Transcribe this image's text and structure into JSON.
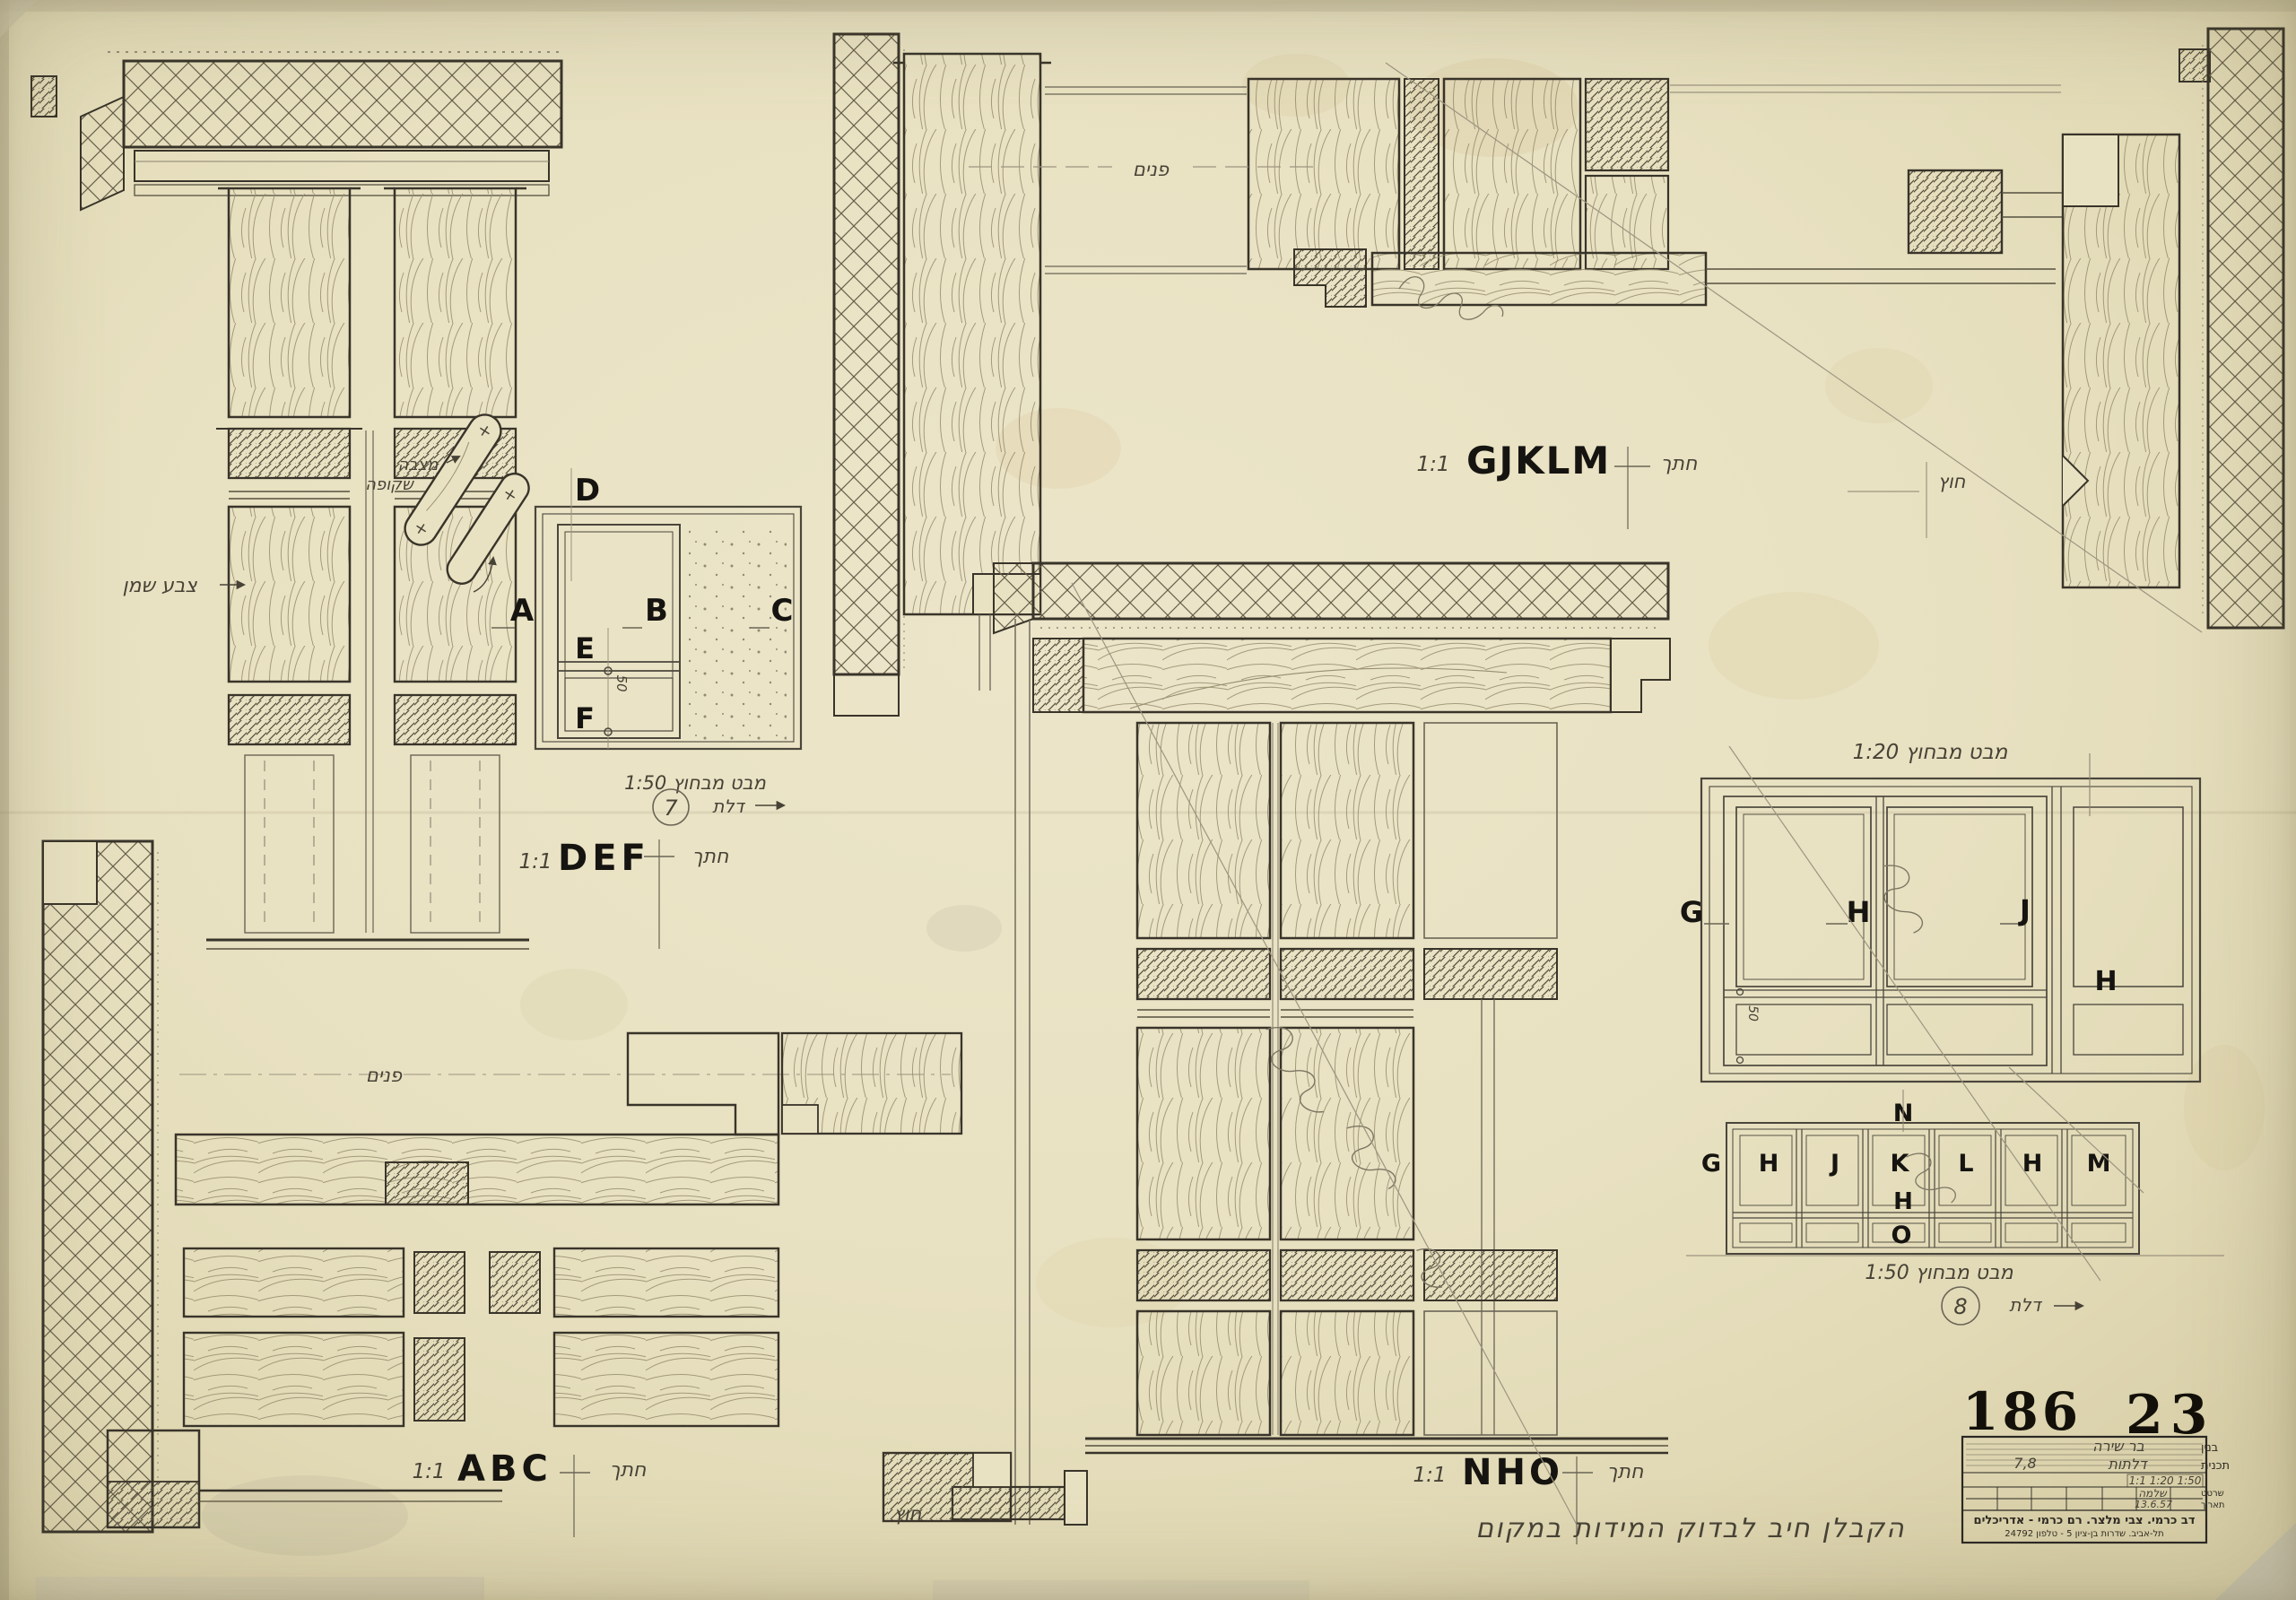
{
  "sheet": {
    "number_left": "186",
    "number_right": "23"
  },
  "section_labels": {
    "gjklm": {
      "scale": "1:1",
      "name": "GJKLM",
      "cut": "חתך"
    },
    "def": {
      "scale": "1:1",
      "name": "DEF",
      "cut": "חתך"
    },
    "abc": {
      "scale": "1:1",
      "name": "ABC",
      "cut": "חתך"
    },
    "nho": {
      "scale": "1:1",
      "name": "NHO",
      "cut": "חתך"
    }
  },
  "door7": {
    "caption": "מבט מבחוץ 1:50",
    "door_word": "דלת",
    "door_number": "7",
    "dim": "50",
    "letters": {
      "D": "D",
      "A": "A",
      "B": "B",
      "C": "C",
      "E": "E",
      "F": "F"
    }
  },
  "elev120": {
    "caption": "מבט מבחוץ 1:20",
    "dim": "50",
    "letters": {
      "G": "G",
      "H": "H",
      "J": "J"
    }
  },
  "door8": {
    "caption": "מבט מבחוץ 1:50",
    "door_word": "דלת",
    "door_number": "8",
    "letters_row": [
      "G",
      "H",
      "J",
      "K",
      "L",
      "H",
      "M"
    ],
    "letter_top": "N",
    "letter_mid": "H",
    "letter_bottom": "O"
  },
  "annotations": {
    "inside_top": "פנים",
    "inside_left": "פנים",
    "outside_right": "חוץ",
    "outside_bottom": "חוץ",
    "oil_paint": "צבע שמן",
    "pull_line1": "מצבה",
    "pull_line2": "שקופה",
    "contractor_note": "הקבלן חיב לבדוק המידות במקום"
  },
  "title_block": {
    "building_label": "בנין",
    "building_value": "בר שירה",
    "plan_label": "תכנית",
    "plan_value": "דלתות",
    "plan_numbers": "7,8",
    "scales_value": "1:1 1:20 1:50",
    "drafter_label": "שרטט",
    "drafter_value": "שלמה",
    "date_label": "תאריך",
    "date_value": "13.6.57",
    "firm_line": "דב כרמי. צבי מלצר. רם כרמי - אדריכלים",
    "address_line": "תל-אביב. שדרות בן-ציון 5 - טלפון 24792"
  }
}
